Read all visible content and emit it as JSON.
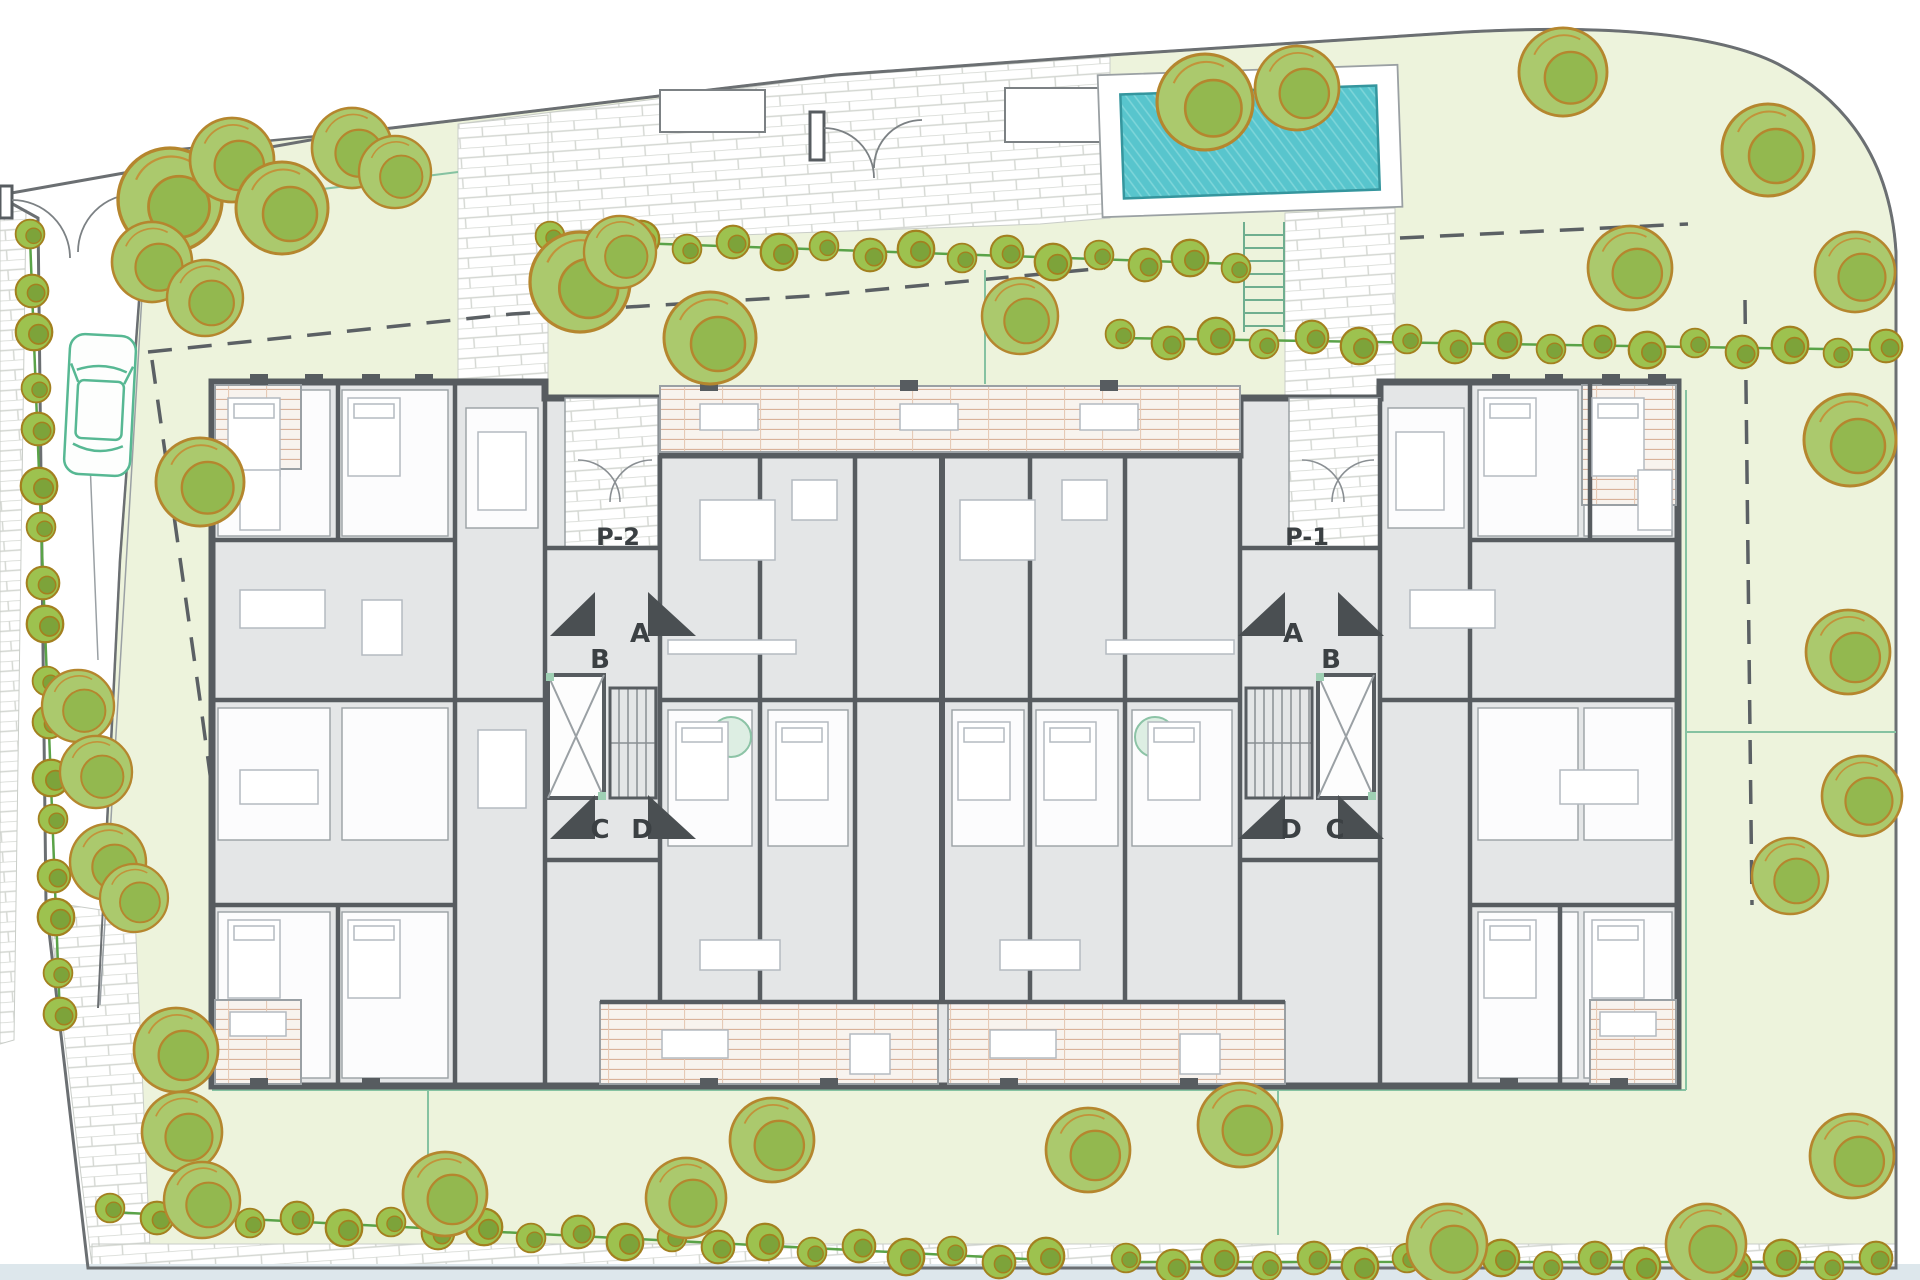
{
  "plan": {
    "type": "architectural-site-plan",
    "labels": {
      "p2": "P-2",
      "p1": "P-1",
      "a": "A",
      "b": "B",
      "c": "C",
      "d": "D"
    },
    "colors": {
      "site_green": "#edf3dc",
      "garden_line": "#85c2a1",
      "pool_water": "#58c5cd",
      "pool_edge": "#35969e",
      "tree_fill": "#abc96d",
      "tree_outline": "#b5862e",
      "bush_fill": "#9dc24f",
      "hedge_line": "#5aa348",
      "wall_gray": "#575c60",
      "floor_gray": "#e4e6e7",
      "terrace_hatch": "#d9b29a",
      "brick_line": "#d4d7d2",
      "boundary_gray": "#6b6f72",
      "car_green": "#57b893",
      "bottom_strip_blue": "#dde7ec",
      "label_text": "#3b4043"
    }
  }
}
